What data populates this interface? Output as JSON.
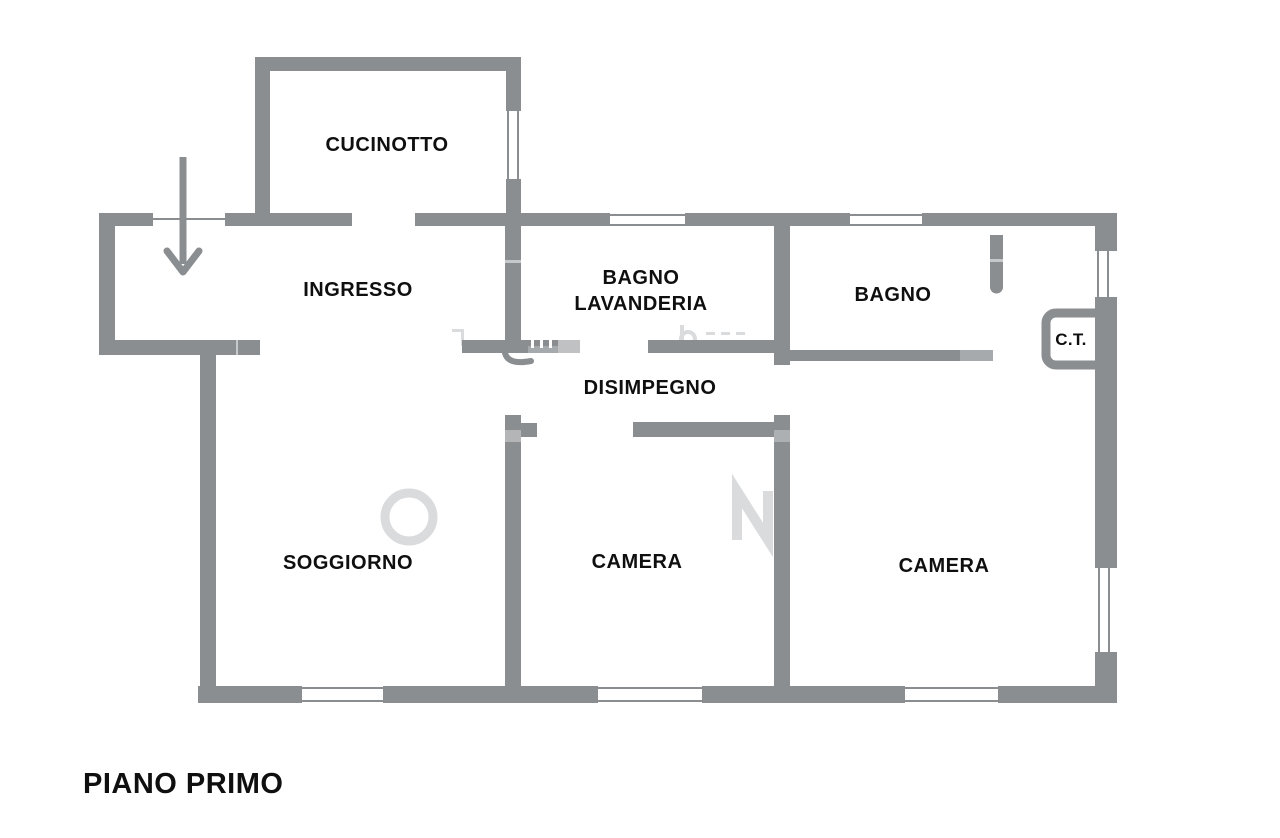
{
  "plan": {
    "floor_label": "PIANO PRIMO",
    "rooms": {
      "cucinotto": {
        "label": "CUCINOTTO"
      },
      "ingresso": {
        "label": "INGRESSO"
      },
      "bagno_lavanderia": {
        "line1": "BAGNO",
        "line2": "LAVANDERIA"
      },
      "bagno": {
        "label": "BAGNO"
      },
      "caldaia": {
        "label": "C.T."
      },
      "disimpegno": {
        "label": "DISIMPEGNO"
      },
      "soggiorno": {
        "label": "SOGGIORNO"
      },
      "camera1": {
        "label": "CAMERA"
      },
      "camera2": {
        "label": "CAMERA"
      }
    },
    "symbols": {
      "entrance_arrow": "entrance-direction-arrow",
      "window_symbol": "double-line-window",
      "door_symbol": "swing-arc"
    },
    "colors": {
      "wall": "#8a8e91",
      "text": "#0f0f0f",
      "background": "#ffffff",
      "watermark": "#dadbdd"
    }
  }
}
